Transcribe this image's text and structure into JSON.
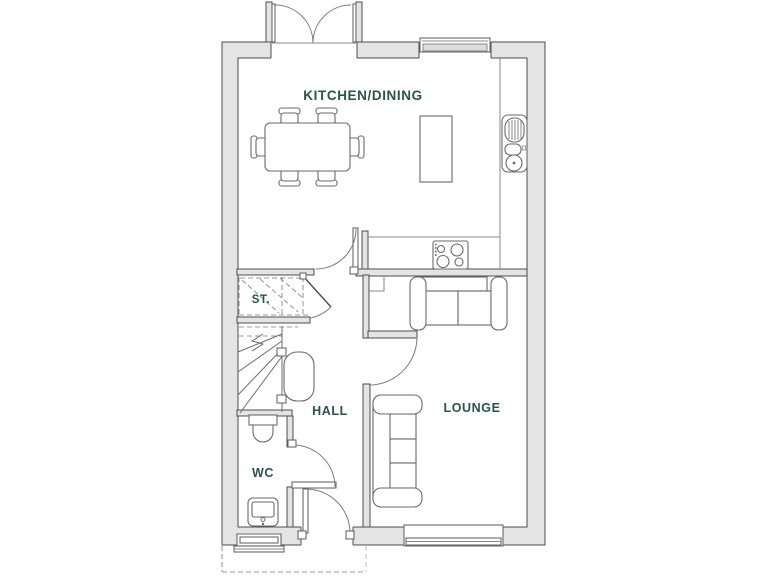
{
  "floorplan": {
    "rooms": {
      "kitchen_dining": {
        "label": "KITCHEN/DINING"
      },
      "storage": {
        "label": "ST."
      },
      "hall": {
        "label": "HALL"
      },
      "wc": {
        "label": "WC"
      },
      "lounge": {
        "label": "LOUNGE"
      }
    },
    "colors": {
      "label": "#2b534c",
      "wall_fill": "#e4e4e4",
      "wall_stroke": "#4c4c4c",
      "furniture_stroke": "#6a6a6a",
      "dashed_outline": "#9a9a9a",
      "dashed_outline_light": "#c6c6c6",
      "background": "#ffffff"
    }
  }
}
